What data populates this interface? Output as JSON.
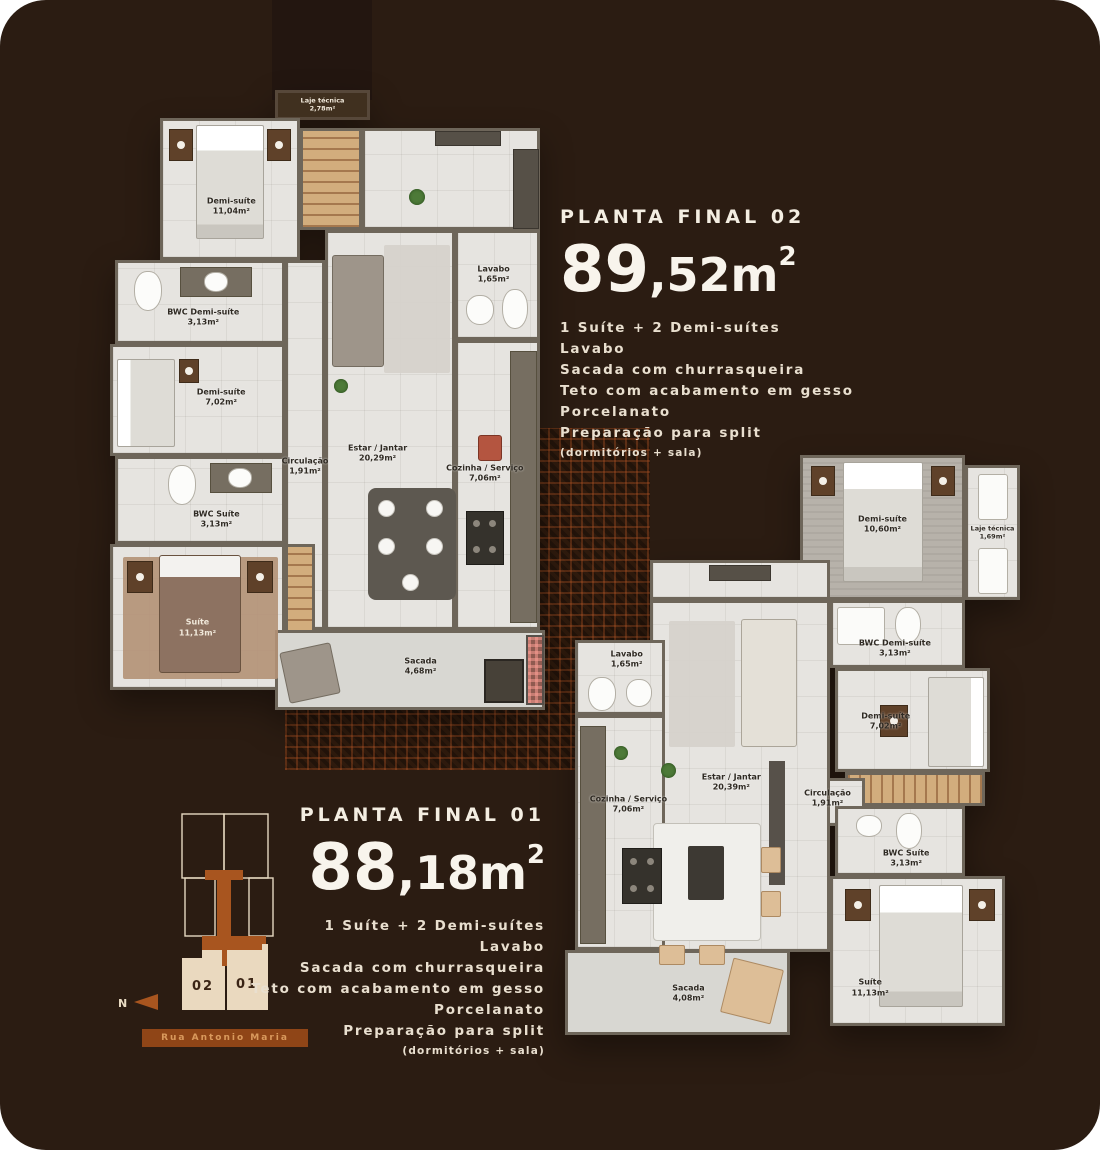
{
  "colors": {
    "background": "#2b1c12",
    "accent_orange": "#a8551f",
    "cream": "#e9dcc4",
    "street_bar": "#8f4517"
  },
  "plan02": {
    "title": "PLANTA FINAL 02",
    "area_big": "89",
    "area_mid": ",52m",
    "area_sup": "2",
    "features": [
      "1 Suíte + 2 Demi-suítes",
      "Lavabo",
      "Sacada com churrasqueira",
      "Teto com acabamento em gesso",
      "Porcelanato",
      "Preparação para split"
    ],
    "features_note": "(dormitórios + sala)",
    "rooms": {
      "laje": {
        "name": "Laje técnica",
        "area": "2,78m²"
      },
      "demi_top": {
        "name": "Demi-suíte",
        "area": "11,04m²"
      },
      "bwc_demi": {
        "name": "BWC Demi-suíte",
        "area": "3,13m²"
      },
      "demi_mid": {
        "name": "Demi-suíte",
        "area": "7,02m²"
      },
      "circulacao": {
        "name": "Circulação",
        "area": "1,91m²"
      },
      "bwc_suite": {
        "name": "BWC Suíte",
        "area": "3,13m²"
      },
      "suite": {
        "name": "Suíte",
        "area": "11,13m²"
      },
      "estar": {
        "name": "Estar / Jantar",
        "area": "20,29m²"
      },
      "lavabo": {
        "name": "Lavabo",
        "area": "1,65m²"
      },
      "cozinha": {
        "name": "Cozinha / Serviço",
        "area": "7,06m²"
      },
      "sacada": {
        "name": "Sacada",
        "area": "4,68m²"
      }
    }
  },
  "plan01": {
    "title": "PLANTA FINAL 01",
    "area_big": "88",
    "area_mid": ",18m",
    "area_sup": "2",
    "features": [
      "1 Suíte + 2 Demi-suítes",
      "Lavabo",
      "Sacada com churrasqueira",
      "Teto com acabamento em gesso",
      "Porcelanato",
      "Preparação para split"
    ],
    "features_note": "(dormitórios + sala)",
    "rooms": {
      "demi_top": {
        "name": "Demi-suíte",
        "area": "10,60m²"
      },
      "laje": {
        "name": "Laje técnica",
        "area": "1,69m²"
      },
      "bwc_demi": {
        "name": "BWC Demi-suíte",
        "area": "3,13m²"
      },
      "demi_mid": {
        "name": "Demi-suíte",
        "area": "7,02m²"
      },
      "circulacao": {
        "name": "Circulação",
        "area": "1,91m²"
      },
      "bwc_suite": {
        "name": "BWC Suíte",
        "area": "3,13m²"
      },
      "suite": {
        "name": "Suíte",
        "area": "11,13m²"
      },
      "estar": {
        "name": "Estar / Jantar",
        "area": "20,39m²"
      },
      "lavabo": {
        "name": "Lavabo",
        "area": "1,65m²"
      },
      "cozinha": {
        "name": "Cozinha / Serviço",
        "area": "7,06m²"
      },
      "sacada": {
        "name": "Sacada",
        "area": "4,08m²"
      }
    }
  },
  "keyplan": {
    "unit_02": "02",
    "unit_01": "01",
    "street": "Rua Antonio Maria",
    "north_label": "N"
  }
}
